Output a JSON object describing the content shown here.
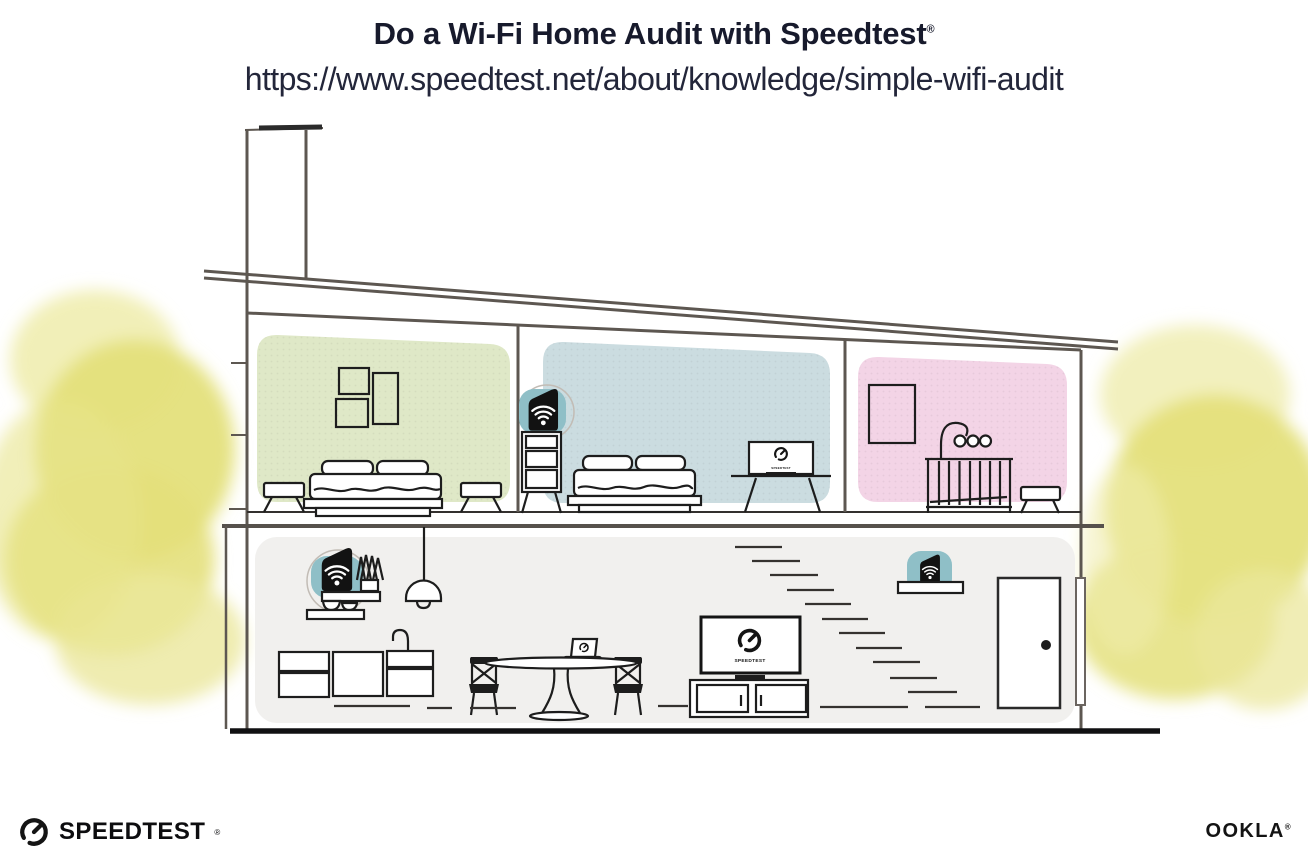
{
  "header": {
    "title": "Do a Wi-Fi Home Audit with Speedtest",
    "trademark": "®",
    "url": "https://www.speedtest.net/about/knowledge/simple-wifi-audit"
  },
  "illustration": {
    "description": "Cross-section of a two-story house showing ideal Wi-Fi router and mesh unit placement",
    "rooms": [
      {
        "name": "upstairs-bedroom-left",
        "wall_color": "#dfe8c7"
      },
      {
        "name": "upstairs-bedroom-middle",
        "wall_color": "#cbdce0"
      },
      {
        "name": "upstairs-nursery",
        "wall_color": "#f3d4e6"
      },
      {
        "name": "downstairs-living-area",
        "wall_color": "#f1f0ee"
      }
    ],
    "devices": [
      {
        "name": "wifi-router-on-kitchen-shelf",
        "accent_color": "#8fbfc7"
      },
      {
        "name": "wifi-mesh-unit-on-bedroom-dresser",
        "accent_color": "#8fbfc7"
      },
      {
        "name": "wifi-mesh-unit-on-stair-shelf",
        "accent_color": "#8fbfc7"
      }
    ],
    "screens": {
      "living_tv_label": "SPEEDTEST",
      "bedroom_tv_label": "SPEEDTEST"
    },
    "foliage_color": "#e4e07b",
    "line_color": "#5d5751"
  },
  "footer": {
    "speedtest_wordmark": "SPEEDTEST",
    "speedtest_trademark": "®",
    "ookla_wordmark": "OOKLA",
    "ookla_trademark": "®"
  }
}
